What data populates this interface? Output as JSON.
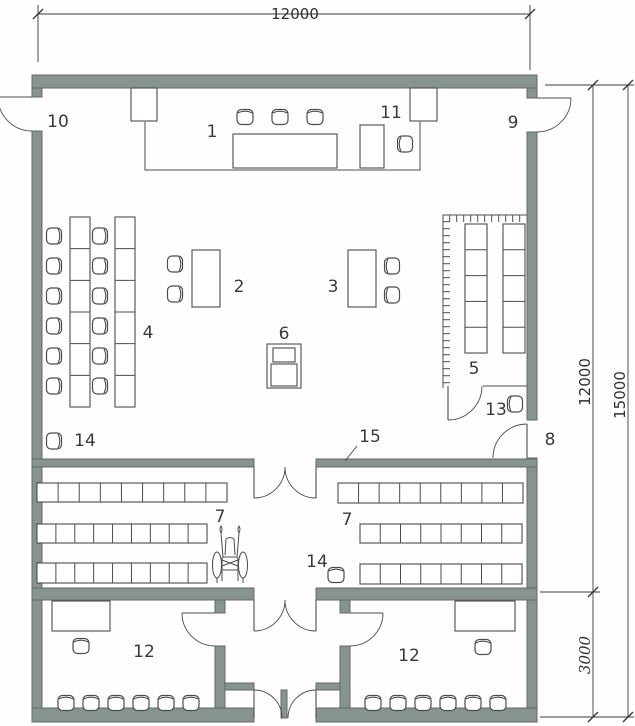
{
  "meta": {
    "type": "architectural-floor-plan",
    "units_implied": "mm"
  },
  "colors": {
    "wall_fill": "#87948d",
    "wall_edge": "#5f6c66",
    "line": "#4c4c4c",
    "dim": "#3a3a3a",
    "background": "#fffefd"
  },
  "dimension_labels": [
    {
      "text": "12000",
      "x": 295,
      "y": 19,
      "rot": 0,
      "italic": false
    },
    {
      "text": "12000",
      "x": 590,
      "y": 382,
      "rot": -90,
      "italic": false
    },
    {
      "text": "15000",
      "x": 625,
      "y": 395,
      "rot": -90,
      "italic": false
    },
    {
      "text": "3000",
      "x": 590,
      "y": 655,
      "rot": -90,
      "italic": true
    }
  ],
  "room_labels": [
    {
      "n": "1",
      "x": 212,
      "y": 137
    },
    {
      "n": "2",
      "x": 239,
      "y": 292
    },
    {
      "n": "3",
      "x": 333,
      "y": 292
    },
    {
      "n": "4",
      "x": 148,
      "y": 338
    },
    {
      "n": "5",
      "x": 474,
      "y": 374
    },
    {
      "n": "6",
      "x": 284,
      "y": 339
    },
    {
      "n": "7",
      "x": 220,
      "y": 522
    },
    {
      "n": "7",
      "x": 347,
      "y": 525
    },
    {
      "n": "8",
      "x": 550,
      "y": 445
    },
    {
      "n": "9",
      "x": 513,
      "y": 128
    },
    {
      "n": "10",
      "x": 58,
      "y": 127
    },
    {
      "n": "11",
      "x": 391,
      "y": 118
    },
    {
      "n": "12",
      "x": 144,
      "y": 657
    },
    {
      "n": "12",
      "x": 409,
      "y": 661
    },
    {
      "n": "13",
      "x": 496,
      "y": 415
    },
    {
      "n": "14",
      "x": 85,
      "y": 446
    },
    {
      "n": "14",
      "x": 317,
      "y": 567
    },
    {
      "n": "15",
      "x": 370,
      "y": 442
    }
  ],
  "plan": {
    "walls": [
      [
        32,
        75,
        505,
        13
      ],
      [
        32,
        88,
        10,
        9
      ],
      [
        32,
        131,
        10,
        591
      ],
      [
        527,
        88,
        10,
        10
      ],
      [
        527,
        132,
        10,
        288
      ],
      [
        527,
        458,
        10,
        264
      ],
      [
        32,
        708,
        222,
        14
      ],
      [
        316,
        708,
        221,
        14
      ],
      [
        32,
        459,
        222,
        8
      ],
      [
        316,
        459,
        221,
        8
      ],
      [
        32,
        588,
        222,
        12
      ],
      [
        316,
        588,
        221,
        12
      ],
      [
        215,
        600,
        10,
        13
      ],
      [
        215,
        646,
        10,
        62
      ],
      [
        340,
        600,
        10,
        13
      ],
      [
        340,
        646,
        10,
        62
      ],
      [
        225,
        683,
        29,
        7
      ],
      [
        316,
        683,
        24,
        7
      ],
      [
        281,
        690,
        6,
        28
      ]
    ],
    "lines": [
      "M145,122 L145,170 L420,170 L420,122",
      "M527,215 L443,215 L443,388",
      "M483,386 L527,386",
      "M144,88 L144,121",
      "M423,88 L423,121",
      "M357,446 L345,461"
    ],
    "tick_lines": [
      [
        449,
        218.5,
        525,
        218.5
      ],
      [
        446.5,
        221,
        446.5,
        384
      ]
    ],
    "rects": [
      [
        233,
        134,
        104,
        34
      ],
      [
        360,
        125,
        24,
        43
      ],
      [
        192,
        250,
        28,
        57
      ],
      [
        348,
        250,
        28,
        57
      ],
      [
        52,
        601,
        58,
        30
      ],
      [
        455,
        601,
        60,
        30
      ],
      [
        131,
        88,
        26,
        33
      ],
      [
        410,
        88,
        27,
        33
      ],
      [
        267,
        344,
        34,
        44
      ],
      [
        273,
        348,
        22,
        14
      ],
      [
        271,
        364,
        26,
        22
      ]
    ],
    "shelves": [
      [
        37,
        483,
        190,
        19,
        9,
        "h"
      ],
      [
        37,
        524,
        170,
        19,
        9,
        "h"
      ],
      [
        37,
        563,
        170,
        20,
        9,
        "h"
      ],
      [
        338,
        483,
        185,
        20,
        9,
        "h"
      ],
      [
        360,
        524,
        162,
        19,
        8,
        "h"
      ],
      [
        360,
        564,
        162,
        20,
        8,
        "h"
      ],
      [
        70,
        217,
        20,
        190,
        6,
        "v"
      ],
      [
        115,
        217,
        20,
        190,
        6,
        "v"
      ],
      [
        465,
        224,
        22,
        129,
        5,
        "v"
      ],
      [
        503,
        224,
        22,
        129,
        5,
        "v"
      ]
    ],
    "chairs": [
      [
        55,
        236,
        0
      ],
      [
        55,
        266,
        0
      ],
      [
        55,
        296,
        0
      ],
      [
        55,
        326,
        0
      ],
      [
        55,
        356,
        0
      ],
      [
        55,
        386,
        0
      ],
      [
        101,
        236,
        0
      ],
      [
        101,
        266,
        0
      ],
      [
        101,
        296,
        0
      ],
      [
        101,
        326,
        0
      ],
      [
        101,
        356,
        0
      ],
      [
        101,
        386,
        0
      ],
      [
        176,
        264,
        0
      ],
      [
        176,
        294,
        0
      ],
      [
        391,
        266,
        180
      ],
      [
        391,
        295,
        180
      ],
      [
        404,
        144,
        180
      ],
      [
        514,
        404,
        180
      ],
      [
        55,
        441,
        0
      ],
      [
        336,
        574,
        -90
      ],
      [
        81,
        645,
        -90
      ],
      [
        66,
        702,
        -90
      ],
      [
        91,
        702,
        -90
      ],
      [
        116,
        702,
        -90
      ],
      [
        141,
        702,
        -90
      ],
      [
        166,
        702,
        -90
      ],
      [
        191,
        702,
        -90
      ],
      [
        483,
        646,
        -90
      ],
      [
        373,
        702,
        -90
      ],
      [
        398,
        702,
        -90
      ],
      [
        423,
        702,
        -90
      ],
      [
        448,
        702,
        -90
      ],
      [
        473,
        702,
        -90
      ],
      [
        498,
        702,
        -90
      ],
      [
        245,
        116,
        -90
      ],
      [
        280,
        116,
        -90
      ],
      [
        315,
        116,
        -90
      ]
    ],
    "doors": [
      [
        32,
        97,
        34,
        180,
        90
      ],
      [
        537,
        98,
        34,
        0,
        90
      ],
      [
        527,
        458,
        34,
        270,
        180
      ],
      [
        448,
        386,
        34,
        90,
        0
      ],
      [
        215,
        613,
        33,
        180,
        90
      ],
      [
        350,
        613,
        33,
        0,
        90
      ],
      [
        254,
        467,
        31,
        90,
        0
      ],
      [
        316,
        467,
        31,
        90,
        180
      ],
      [
        254,
        600,
        31,
        90,
        0
      ],
      [
        316,
        600,
        31,
        90,
        180
      ],
      [
        254,
        718,
        28,
        270,
        0
      ],
      [
        316,
        718,
        28,
        270,
        180
      ]
    ],
    "dim_lines": [
      "M38,5 V62",
      "M530,5 V70",
      "M38,14 H530",
      "M545,85 H634",
      "M540,592 H600",
      "M540,717 H634",
      "M593,85 V717",
      "M628,85 V717"
    ],
    "dim_ticks": [
      [
        38,
        14
      ],
      [
        530,
        14
      ],
      [
        593,
        85
      ],
      [
        628,
        85
      ],
      [
        593,
        592
      ],
      [
        593,
        717
      ],
      [
        628,
        717
      ]
    ],
    "wheelchair": {
      "x": 230,
      "y": 557
    }
  }
}
